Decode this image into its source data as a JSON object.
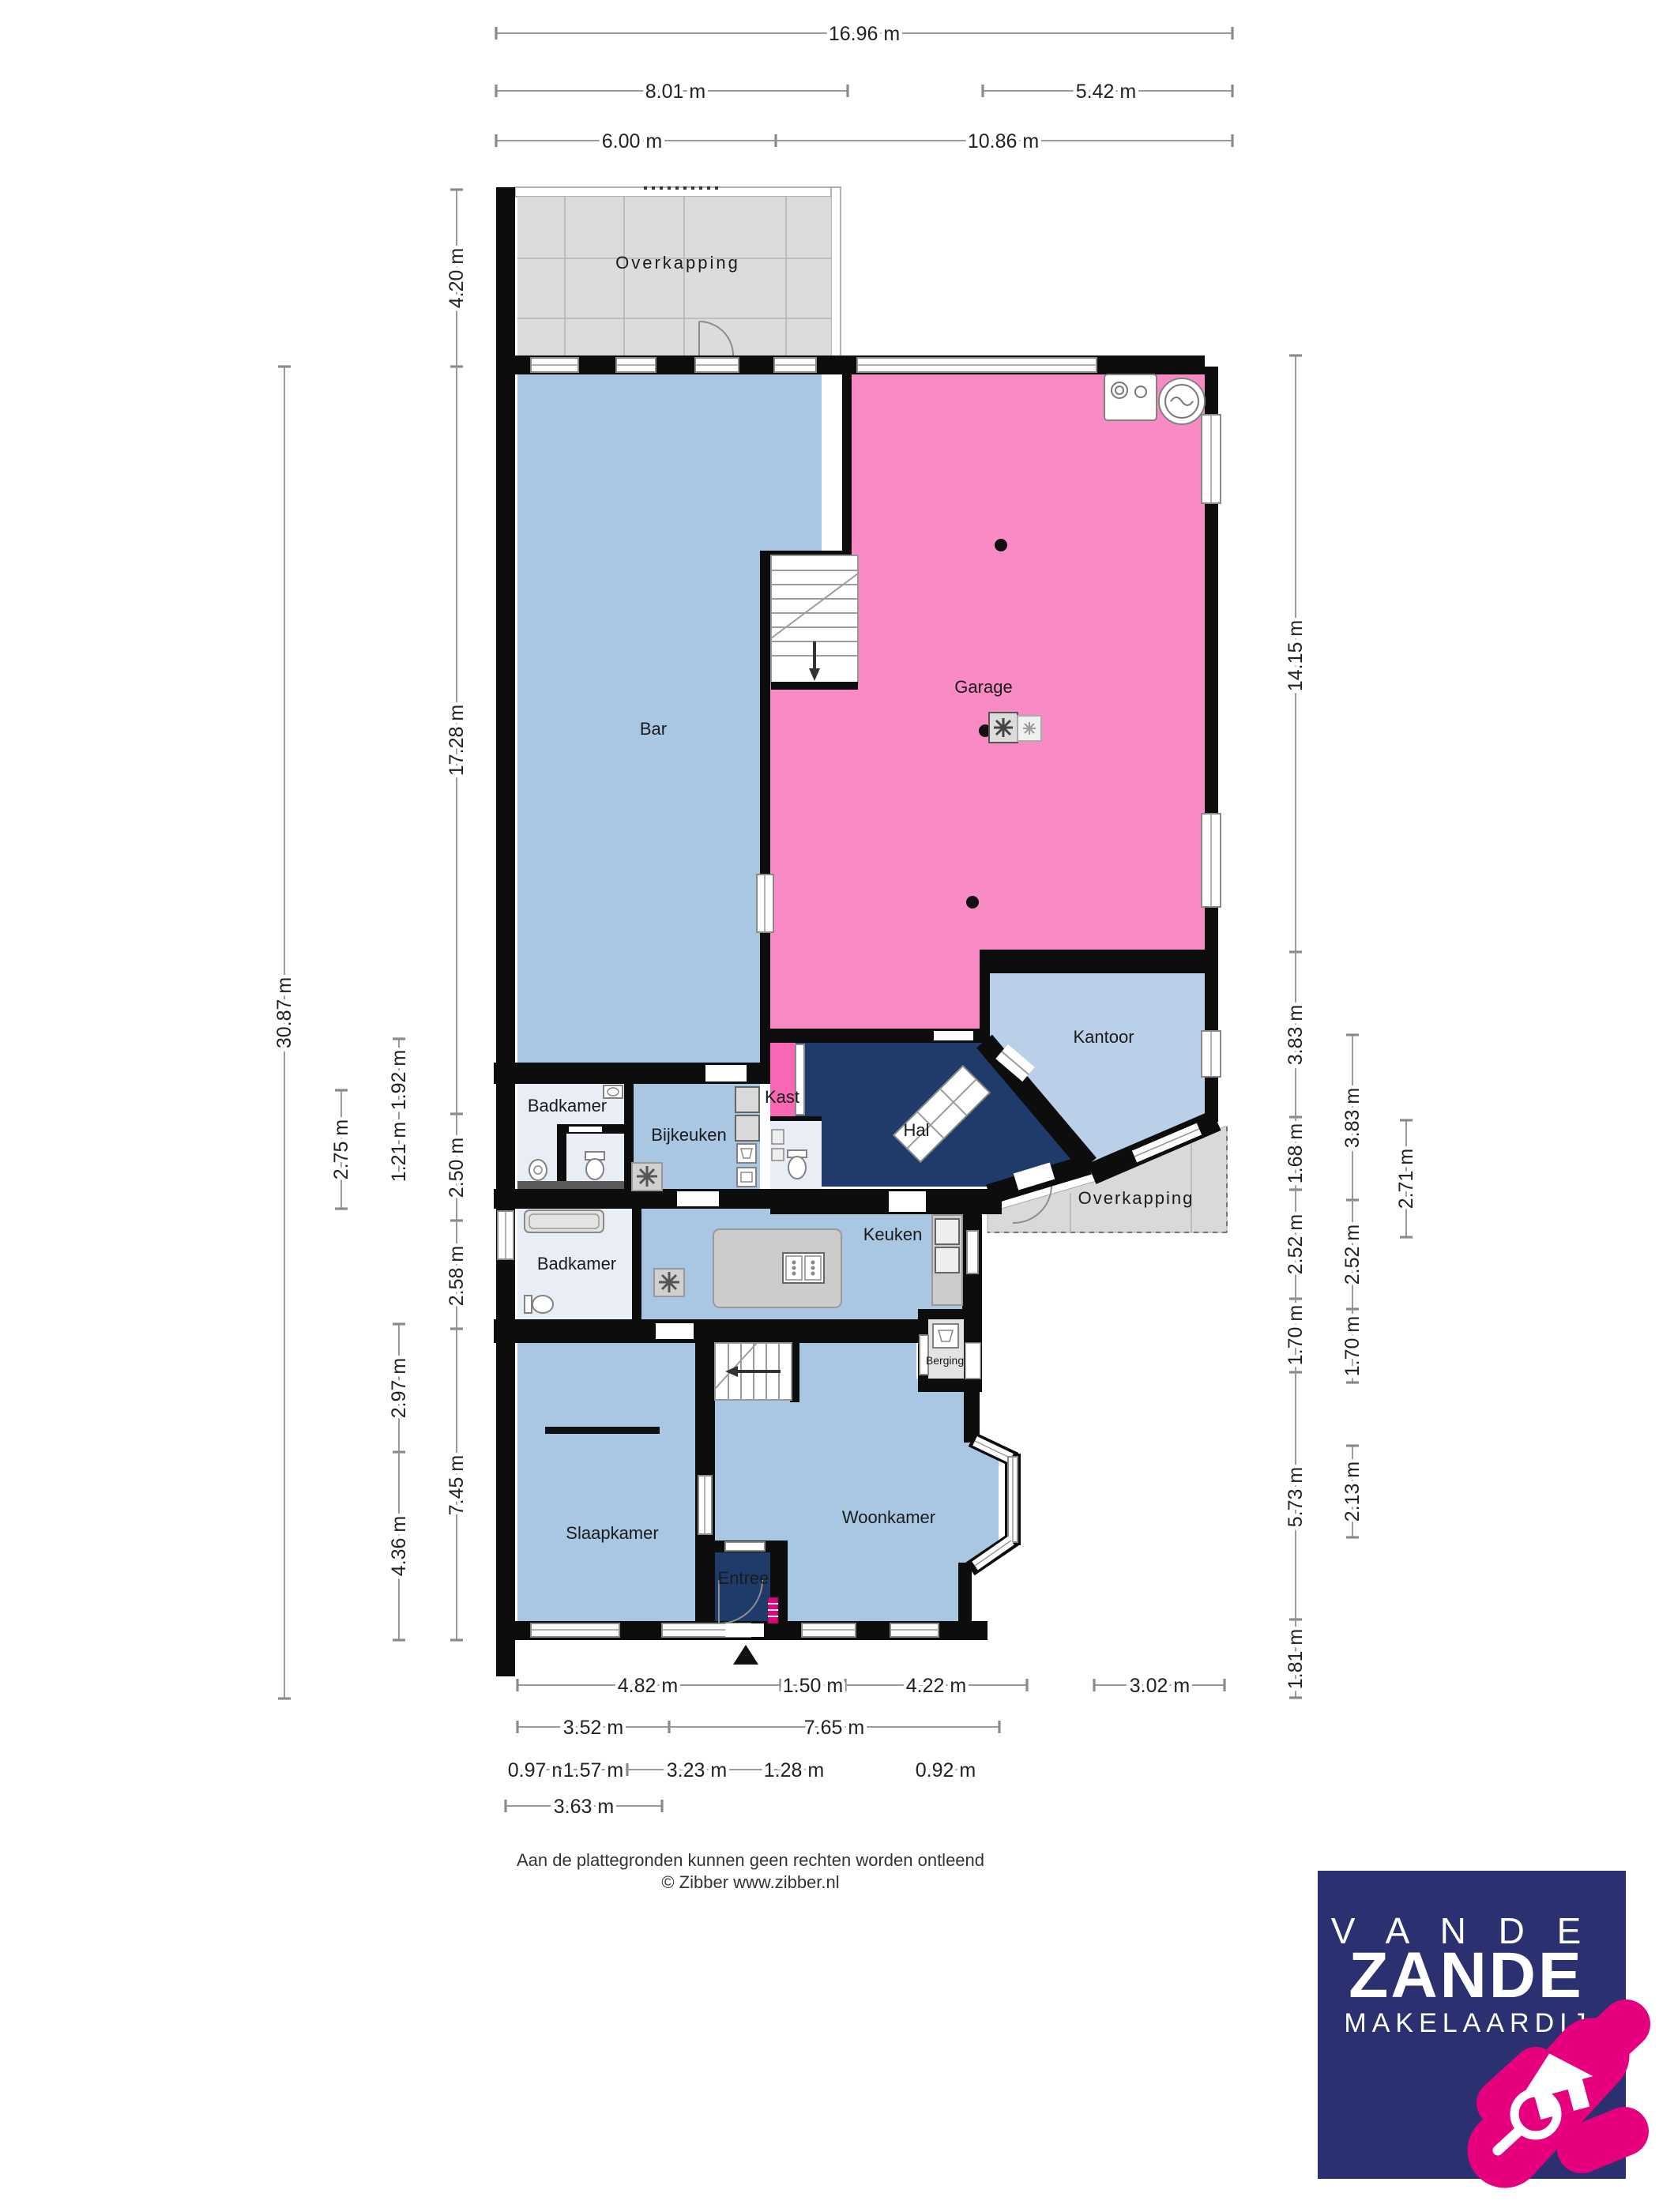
{
  "dims": {
    "top": [
      "16.96 m",
      "8.01 m",
      "5.42 m",
      "6.00 m",
      "10.86 m"
    ],
    "left": [
      "4.20 m",
      "17.28 m",
      "2.50 m",
      "2.58 m",
      "7.45 m",
      "1.92 m",
      "1.21 m",
      "2.97 m",
      "4.36 m",
      "2.75 m",
      "30.87 m"
    ],
    "right": [
      "14.15 m",
      "3.83 m",
      "1.68 m",
      "2.52 m",
      "1.70 m",
      "5.73 m",
      "1.81 m",
      "3.83 m",
      "2.52 m",
      "1.70 m",
      "2.13 m",
      "2.71 m"
    ],
    "bottom": [
      "4.82 m",
      "1.50 m",
      "4.22 m",
      "3.02 m",
      "3.52 m",
      "7.65 m",
      "0.97 m",
      "1.57 m",
      "3.23 m",
      "1.28 m",
      "0.92 m",
      "3.63 m"
    ]
  },
  "rooms": {
    "overkapping_top": "Overkapping",
    "bar": "Bar",
    "garage": "Garage",
    "kantoor": "Kantoor",
    "kast": "Kast",
    "hal": "Hal",
    "badkamer_boven": "Badkamer",
    "bijkeuken": "Bijkeuken",
    "overkapping_rechts": "Overkapping",
    "badkamer": "Badkamer",
    "keuken": "Keuken",
    "berging": "Berging",
    "slaapkamer": "Slaapkamer",
    "woonkamer": "Woonkamer",
    "entree": "Entree"
  },
  "footer": {
    "disclaimer": "Aan de plattegronden kunnen geen rechten worden ontleend",
    "copyright": "© Zibber www.zibber.nl"
  },
  "logo": {
    "top": "V A N  D E",
    "name": "ZANDE",
    "sub": "MAKELAARDIJ"
  },
  "colors": {
    "room_blue": "#a9c6e3",
    "room_pale": "#e9eef6",
    "hall_navy": "#1e3b69",
    "garage_pink": "#f98bc4",
    "kast_pink": "#f767b4",
    "overkapping_gray": "#dcdcdc",
    "berging_gray": "#e3e3e3",
    "wall_black": "#0d0d0d",
    "logo_navy": "#2b3170",
    "logo_pink": "#e6007e"
  }
}
